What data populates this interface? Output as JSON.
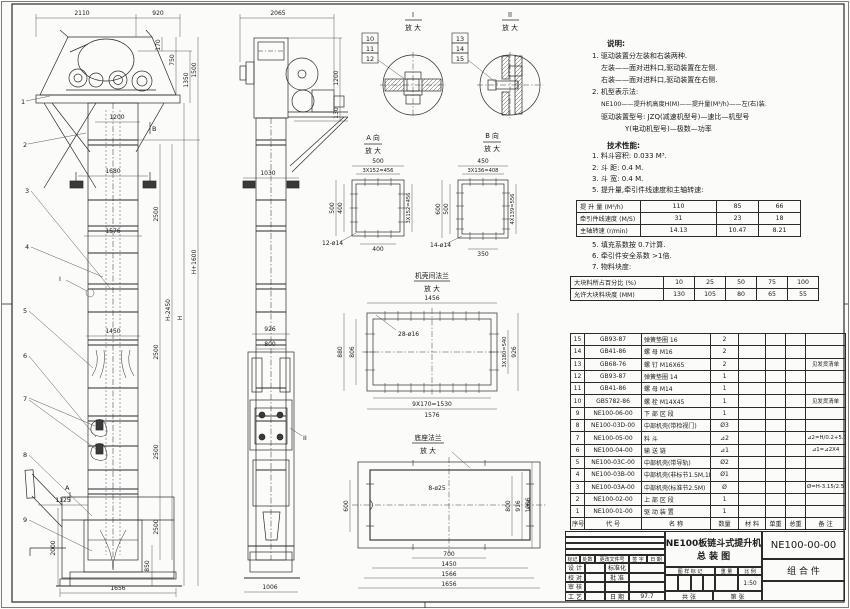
{
  "doc": {
    "sheet_name": "NE100 bucket elevator general assembly drawing"
  },
  "notes": {
    "heading": "说明:",
    "items": [
      "1. 驱动装置分左装和右装两种.",
      "左装——面对进料口,驱动装置在左侧.",
      "右装——面对进料口,驱动装置在右侧.",
      "2. 机型表示法:",
      "NE100——提升机高度H(M)——提升量(M³/h)——左(右)装.",
      "驱动装置型号: JZQ(减速机型号)—速比—机型号",
      "Y(电动机型号)—极数—功率"
    ]
  },
  "tech": {
    "heading": "技术性能:",
    "items": [
      "1. 料斗容积: 0.033 M³.",
      "2. 斗  距: 0.4 M.",
      "3. 斗  宽: 0.4 M.",
      "5. 提升量,牵引件线速度和主轴转速:"
    ],
    "items2": [
      "5. 填充系数按 0.7计算.",
      "6. 牵引件安全系数 >1倍.",
      "7. 物料块度:"
    ]
  },
  "speed_table": {
    "rows": [
      [
        "提 升 量 (M³/h)",
        "110",
        "85",
        "66"
      ],
      [
        "牵引件线速度 (M/S)",
        "31",
        "23",
        "18"
      ],
      [
        "主轴转速 (r/min)",
        "14.13",
        "10.47",
        "8.21"
      ]
    ]
  },
  "size_table": {
    "rows": [
      [
        "大块料所占百分比 (%)",
        "10",
        "25",
        "50",
        "75",
        "100"
      ],
      [
        "允许大块料块度 (MM)",
        "130",
        "105",
        "80",
        "65",
        "55"
      ]
    ]
  },
  "parts": {
    "columns": [
      "序号",
      "代  号",
      "名    称",
      "数量",
      "材 料",
      "单重",
      "总重",
      "备  注"
    ],
    "rows": [
      {
        "no": "15",
        "code": "GB93-87",
        "name": "弹簧垫圈 16",
        "qty": "2",
        "mat": "",
        "uw": "",
        "tw": "",
        "note": ""
      },
      {
        "no": "14",
        "code": "GB41-86",
        "name": "螺 母 M16",
        "qty": "2",
        "mat": "",
        "uw": "",
        "tw": "",
        "note": ""
      },
      {
        "no": "13",
        "code": "GB68-76",
        "name": "螺 钉 M16X65",
        "qty": "2",
        "mat": "",
        "uw": "",
        "tw": "",
        "note": "见发货清单"
      },
      {
        "no": "12",
        "code": "GB93-87",
        "name": "弹簧垫圈 14",
        "qty": "1",
        "mat": "",
        "uw": "",
        "tw": "",
        "note": ""
      },
      {
        "no": "11",
        "code": "GB41-86",
        "name": "螺 母 M14",
        "qty": "1",
        "mat": "",
        "uw": "",
        "tw": "",
        "note": ""
      },
      {
        "no": "10",
        "code": "GB5782-86",
        "name": "螺 栓 M14X45",
        "qty": "1",
        "mat": "",
        "uw": "",
        "tw": "",
        "note": "见发货清单"
      },
      {
        "no": "9",
        "code": "NE100-06-00",
        "name": "下 部 区 段",
        "qty": "1",
        "mat": "",
        "uw": "",
        "tw": "",
        "note": ""
      },
      {
        "no": "8",
        "code": "NE100-03D-00",
        "name": "中部机壳(带检视门)",
        "qty": "Ø3",
        "mat": "",
        "uw": "",
        "tw": "",
        "note": ""
      },
      {
        "no": "7",
        "code": "NE100-05-00",
        "name": "料 斗",
        "qty": "⊿2",
        "mat": "",
        "uw": "",
        "tw": "",
        "note": "⊿2=H/0.2+5.75"
      },
      {
        "no": "6",
        "code": "NE100-04-00",
        "name": "输 送 链",
        "qty": "⊿1",
        "mat": "",
        "uw": "",
        "tw": "",
        "note": "⊿1=⊿2X4"
      },
      {
        "no": "5",
        "code": "NE100-03C-00",
        "name": "中部机壳(带导轨)",
        "qty": "Ø2",
        "mat": "",
        "uw": "",
        "tw": "",
        "note": ""
      },
      {
        "no": "4",
        "code": "NE100-03B-00",
        "name": "中部机壳(非标节1.5M,1M)",
        "qty": "Ø1",
        "mat": "",
        "uw": "",
        "tw": "",
        "note": ""
      },
      {
        "no": "3",
        "code": "NE100-03A-00",
        "name": "中部机壳(标准节2.5M)",
        "qty": "Ø",
        "mat": "",
        "uw": "",
        "tw": "",
        "note": "Ø=H-3.15/2.5"
      },
      {
        "no": "2",
        "code": "NE100-02-00",
        "name": "上 部 区 段",
        "qty": "1",
        "mat": "",
        "uw": "",
        "tw": "",
        "note": ""
      },
      {
        "no": "1",
        "code": "NE100-01-00",
        "name": "驱 动 装 置",
        "qty": "1",
        "mat": "",
        "uw": "",
        "tw": "",
        "note": ""
      }
    ]
  },
  "titleblock": {
    "title_line1": "NE100板链斗式提升机",
    "title_line2": "总  装  图",
    "drawing_no": "NE100-00-00",
    "part_type": "组  合  件",
    "scale_label": "比 例",
    "scale": "1:50",
    "weight_label": "重 量",
    "stamp_label": "图 样 标 记",
    "date": "97.7",
    "rev_cols": [
      "标记",
      "处数",
      "更改文件号",
      "签 字",
      "日 期"
    ],
    "role_design": "设 计",
    "role_check": "校 对",
    "role_audit": "审 核",
    "role_process": "工 艺",
    "role_std": "标准化",
    "role_approve": "批 准",
    "role_date": "日 期",
    "sheet_total": "共  张",
    "sheet_no": "第  张"
  },
  "details": {
    "zoom": "放 大",
    "detail1": "I",
    "detail2": "II",
    "aview": "A 向",
    "bview": "B 向",
    "flange_mid": "机壳间法兰",
    "flange_base": "底座法兰"
  },
  "callouts": {
    "c1": "1",
    "c2": "2",
    "c3": "3",
    "c4": "4",
    "c5": "5",
    "c6": "6",
    "c7": "7",
    "c8": "8",
    "c9": "9",
    "c10": "10",
    "c11": "11",
    "c12": "12",
    "c13": "13",
    "c14": "14",
    "c15": "15",
    "cI": "I",
    "cII": "II",
    "cA": "A",
    "cB": "B"
  },
  "dims": {
    "d2110": "2110",
    "d920": "920",
    "d170": "170",
    "d750": "750",
    "d1350": "1350",
    "d1500": "1500",
    "d1200": "1200",
    "d1680": "1680",
    "d2500": "2500",
    "d1576": "1576",
    "d1450": "1450",
    "d1125": "1125",
    "d2000": "2000",
    "d850": "850",
    "d1656": "1656",
    "dH2450": "H-2450",
    "dH": "H",
    "dH1600": "H+1600",
    "d2065": "2065",
    "d130": "130",
    "d1030": "1030",
    "d926": "926",
    "d800": "800",
    "d1006": "1006",
    "d500": "500",
    "d456": "3X152=456",
    "d400": "400",
    "d12h": "12-ø14",
    "d450": "450",
    "d408": "3X136=408",
    "d600": "600",
    "d556": "4X139=556",
    "d350": "350",
    "d14h": "14-ø14",
    "d1456": "1456",
    "d880": "880",
    "d806": "806",
    "d28h": "28-ø16",
    "d540": "3X180=540",
    "d1530": "9X170=1530",
    "d8h": "8-ø25",
    "d916": "916",
    "d700": "700",
    "d1566": "1566"
  }
}
